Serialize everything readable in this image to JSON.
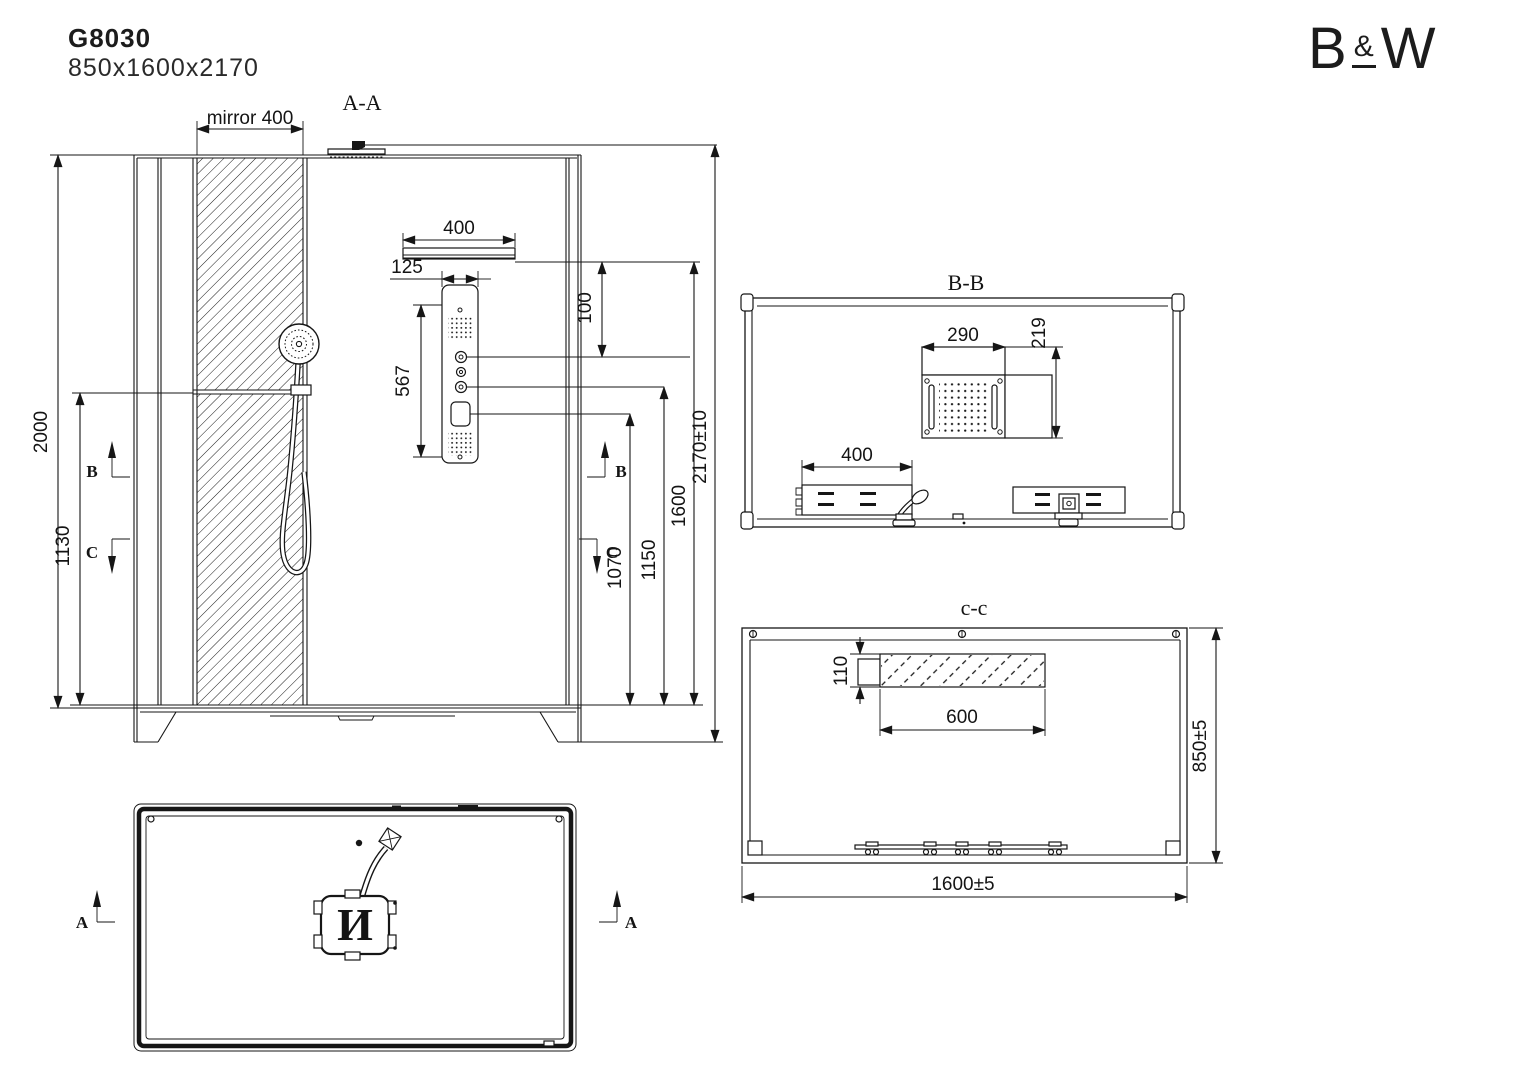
{
  "header": {
    "model": "G8030",
    "size": "850x1600x2170"
  },
  "brand": {
    "b": "B",
    "amp": "&",
    "w": "W"
  },
  "front": {
    "label": "A-A",
    "mirror_dim": "mirror 400",
    "bar_width": "400",
    "panel_width": "125",
    "panel_height": "567",
    "offset_100": "100",
    "height_2000": "2000",
    "height_1130": "1130",
    "height_1070": "1070",
    "height_1150": "1150",
    "height_1600": "1600",
    "height_total": "2170±10",
    "marker_b": "B",
    "marker_c": "C"
  },
  "section_bb": {
    "label": "B-B",
    "head_width": "290",
    "head_depth": "219",
    "panel_width": "400"
  },
  "section_cc": {
    "label": "c-c",
    "shelf_depth": "110",
    "shelf_width": "600",
    "cabin_depth": "850±5",
    "cabin_width": "1600±5"
  },
  "plan": {
    "marker_a": "A",
    "drain_label": "И"
  }
}
